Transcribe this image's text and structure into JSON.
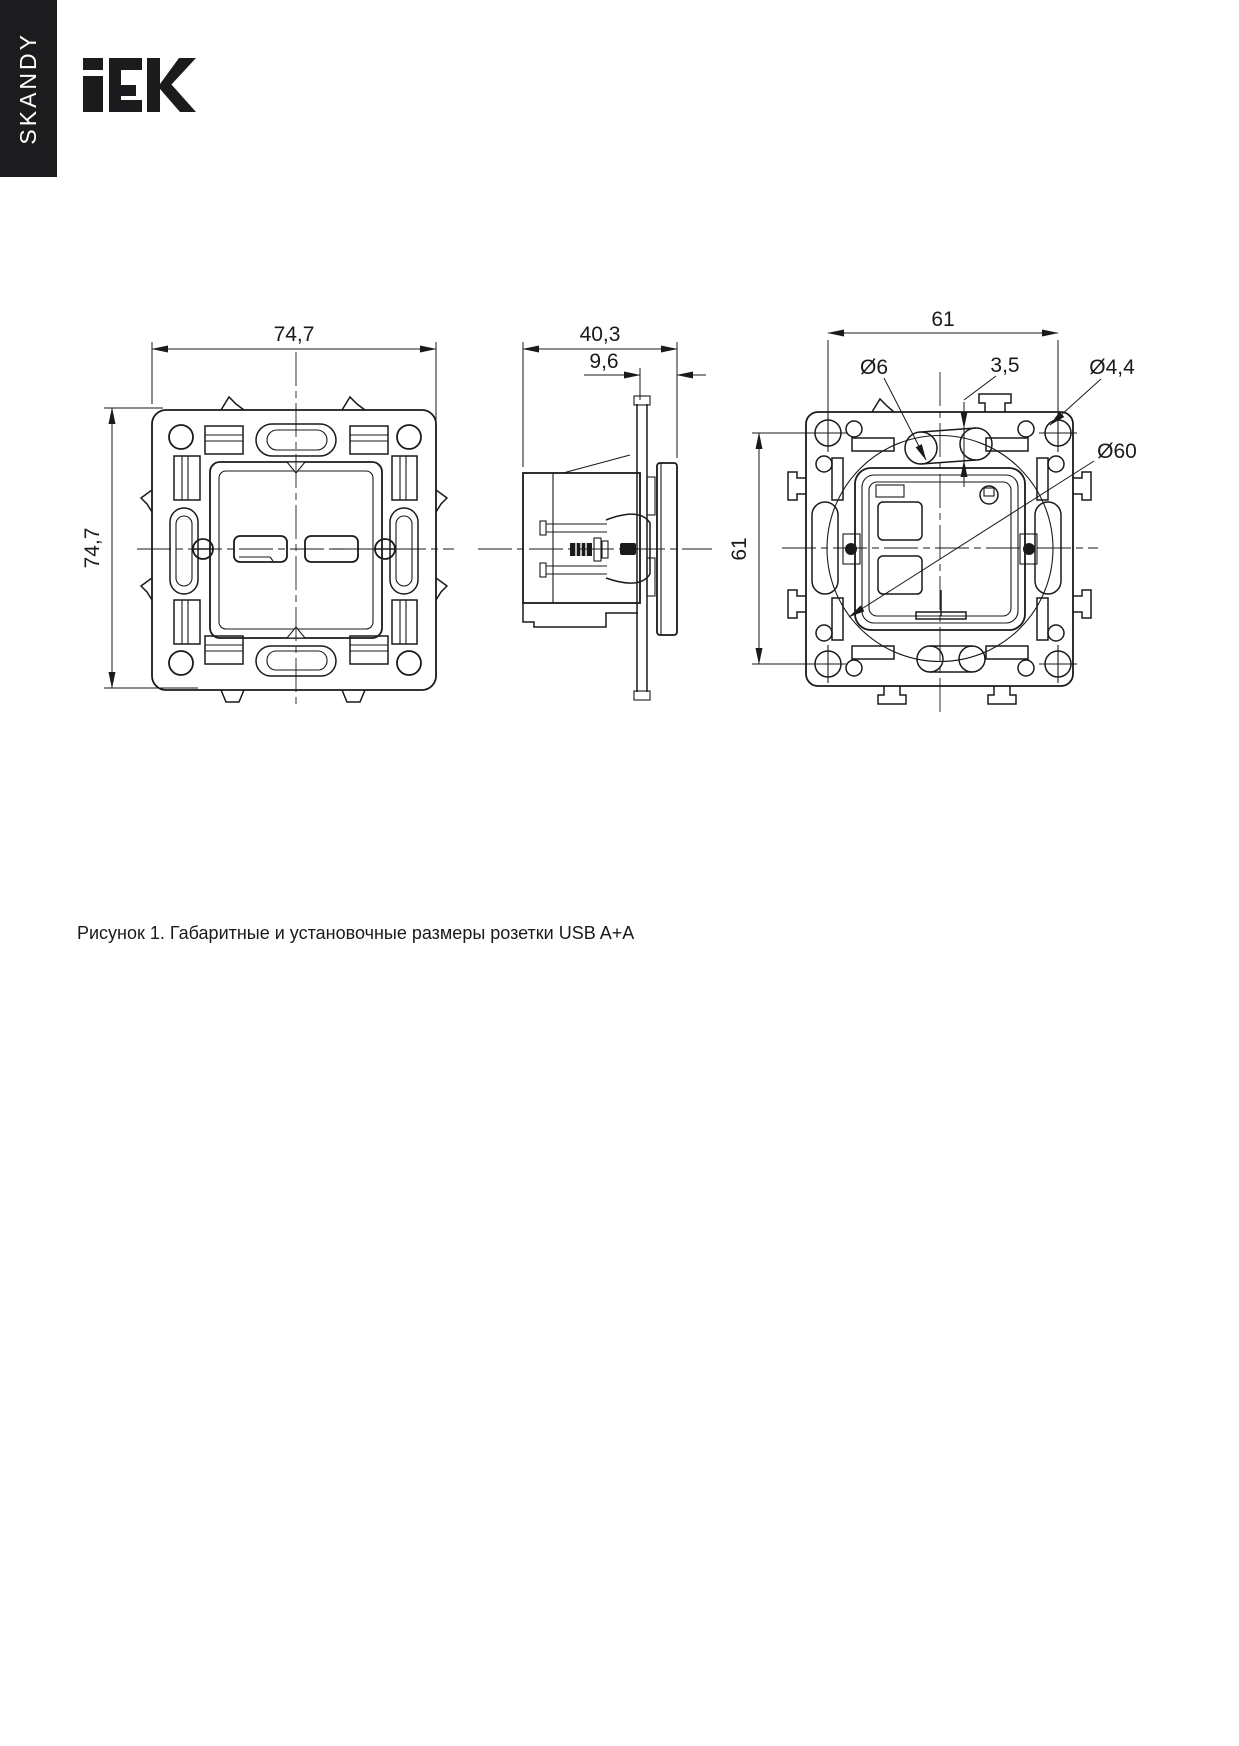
{
  "page": {
    "background": "#ffffff",
    "line_color": "#1a1a1a"
  },
  "sidebar": {
    "series_label": "SKANDY",
    "background": "#1c1c1f",
    "text_color": "#ffffff"
  },
  "header": {
    "logo_text": "iEK"
  },
  "figure": {
    "caption": "Рисунок 1. Габаритные и установочные размеры розетки USB A+A",
    "views": {
      "front": {
        "title": "front-view",
        "dim_width": "74,7",
        "dim_height": "74,7"
      },
      "side": {
        "title": "side-view",
        "dim_depth": "40,3",
        "dim_protrusion": "9,6"
      },
      "rear": {
        "title": "rear-view",
        "dim_hole_spacing_h": "61",
        "dim_hole_spacing_v": "61",
        "label_slot_dia": "Ø6",
        "label_slot_width": "3,5",
        "label_screw_hole_dia": "Ø4,4",
        "label_mount_dia": "Ø60"
      }
    }
  }
}
